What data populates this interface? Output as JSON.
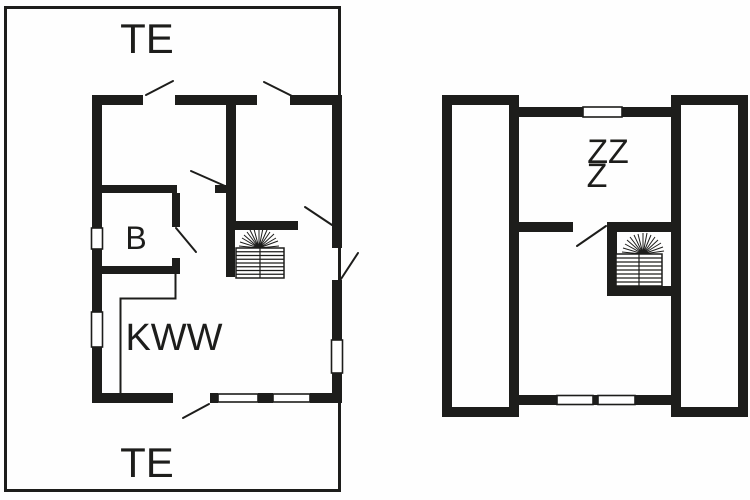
{
  "page": {
    "background_color": "#ffffff",
    "ink_color": "#1d1d1b"
  },
  "ground_floor_plan": {
    "labels": {
      "terrace_top": "TE",
      "terrace_bottom": "TE",
      "bathroom": "B",
      "kitchen_living_room": "KWW"
    },
    "icons": {
      "staircase": "staircase-icon"
    }
  },
  "upper_floor_plan": {
    "labels": {
      "bedrooms_line1": "ZZ",
      "bedrooms_line2": "Z"
    },
    "icons": {
      "staircase": "staircase-icon"
    }
  }
}
